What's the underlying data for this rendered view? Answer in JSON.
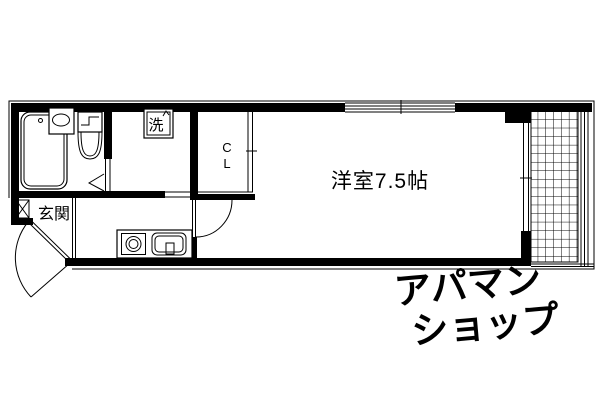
{
  "labels": {
    "entrance": "玄関",
    "laundry": "洗",
    "closet_c": "C",
    "closet_l": "L",
    "main_room": "洋室7.5帖"
  },
  "watermark": {
    "line1": "アパマン",
    "line2": "ショップ",
    "color": "#e9e9e9"
  },
  "colors": {
    "line": "#000000",
    "background": "#ffffff"
  }
}
